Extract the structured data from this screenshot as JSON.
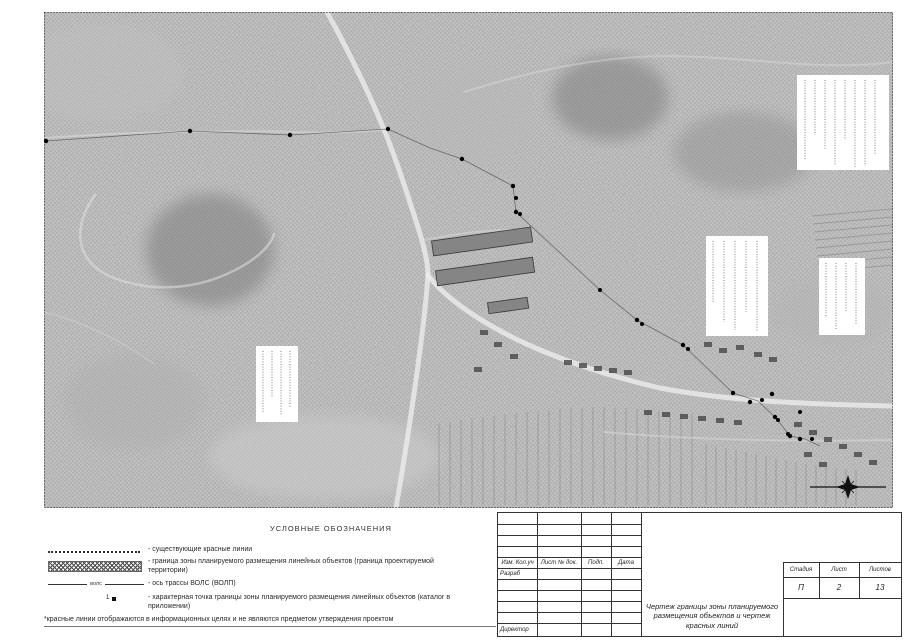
{
  "legend": {
    "title": "УСЛОВНЫЕ ОБОЗНАЧЕНИЯ",
    "items": [
      {
        "symbol": "dotted-line",
        "label": "- существующие красные линии"
      },
      {
        "symbol": "cross-hatch-band",
        "label": "- граница зоны планируемого размещения линейных объектов (граница проектируемой территории)"
      },
      {
        "symbol": "vols-axis-line",
        "label": "- ось трассы ВОЛС (ВОЛП)"
      },
      {
        "symbol": "numbered-point",
        "label": "- характерная точка границы зоны планируемого размещения линейных объектов (каталог в приложении)"
      }
    ],
    "vols_symbol_text": "волс",
    "point_symbol_number": "1",
    "footnote": "*красные линии отображаются в информационных целях и не являются предметом утверждения проектом"
  },
  "titleblock": {
    "cols": [
      "Изм. Кол.уч",
      "Лист № док.",
      "Подп.",
      "Дата"
    ],
    "razrab": "Разраб",
    "director": "Директор",
    "drawing_title": "Чертеж границы зоны планируемого размещения объектов и чертеж красных линий",
    "stage": {
      "label": "Стадия",
      "value": "П"
    },
    "sheet": {
      "label": "Лист",
      "value": "2"
    },
    "sheets": {
      "label": "Листов",
      "value": "13"
    }
  },
  "map": {
    "type": "aerial-photo-plan",
    "colors": {
      "basemap": "#9d9d9d",
      "road": "#ececec",
      "route_point": "#000000",
      "annotation_box": "#ffffff"
    }
  }
}
